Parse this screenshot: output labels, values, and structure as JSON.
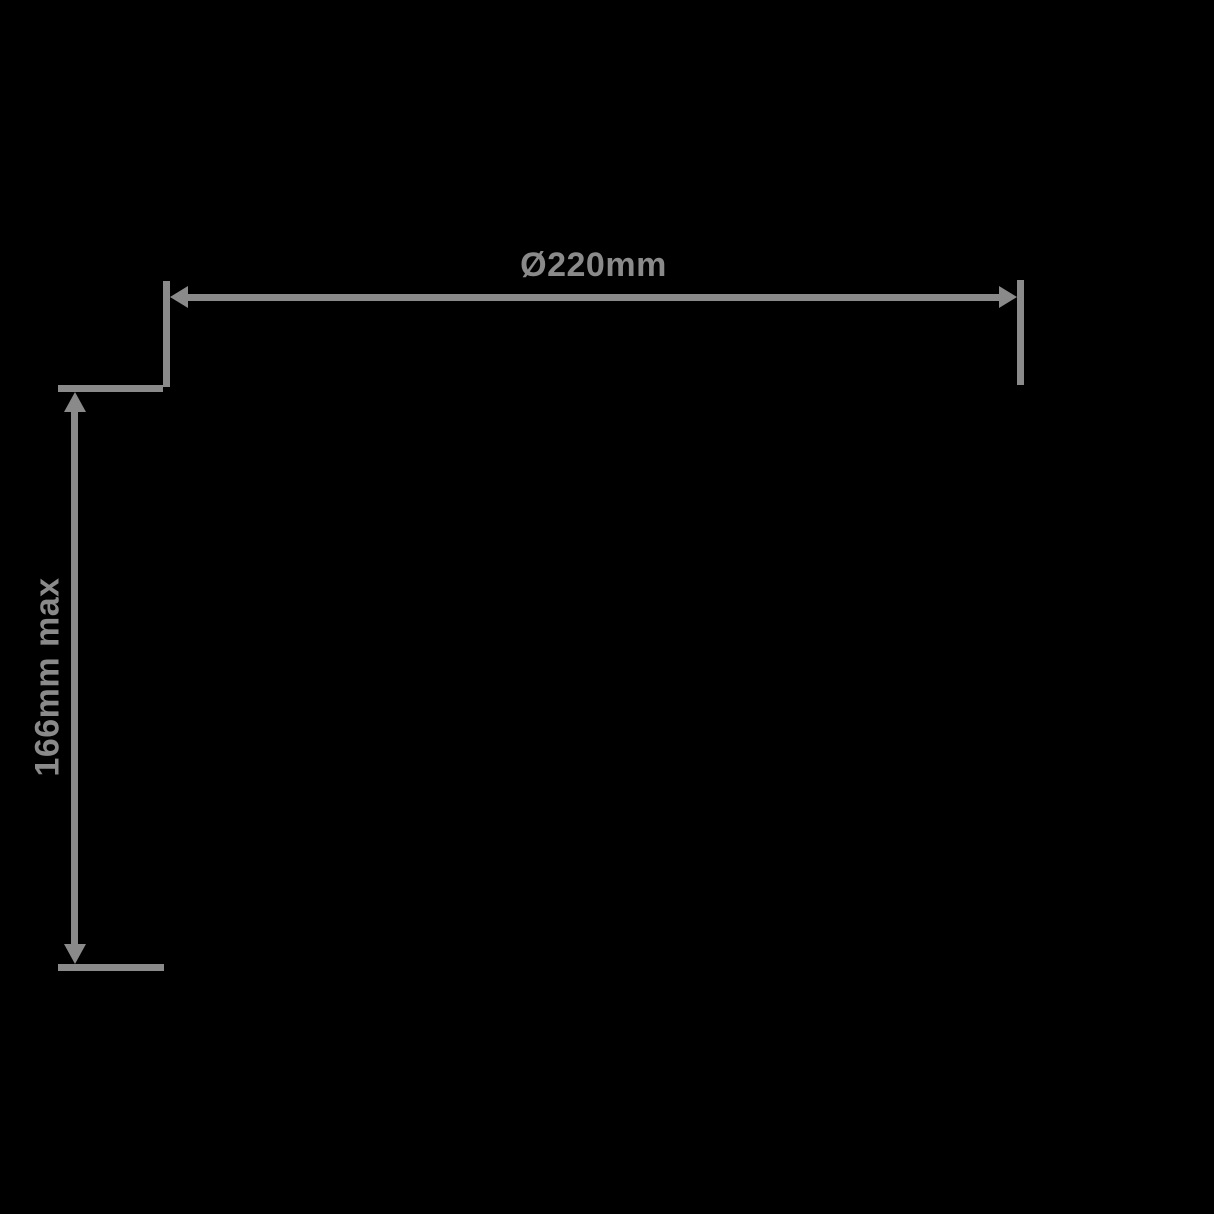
{
  "diagram": {
    "background_color": "#000000",
    "annotation_color": "#8a8a8a",
    "width_dimension": {
      "label": "Ø220mm"
    },
    "height_dimension": {
      "label": "166mm max"
    }
  }
}
